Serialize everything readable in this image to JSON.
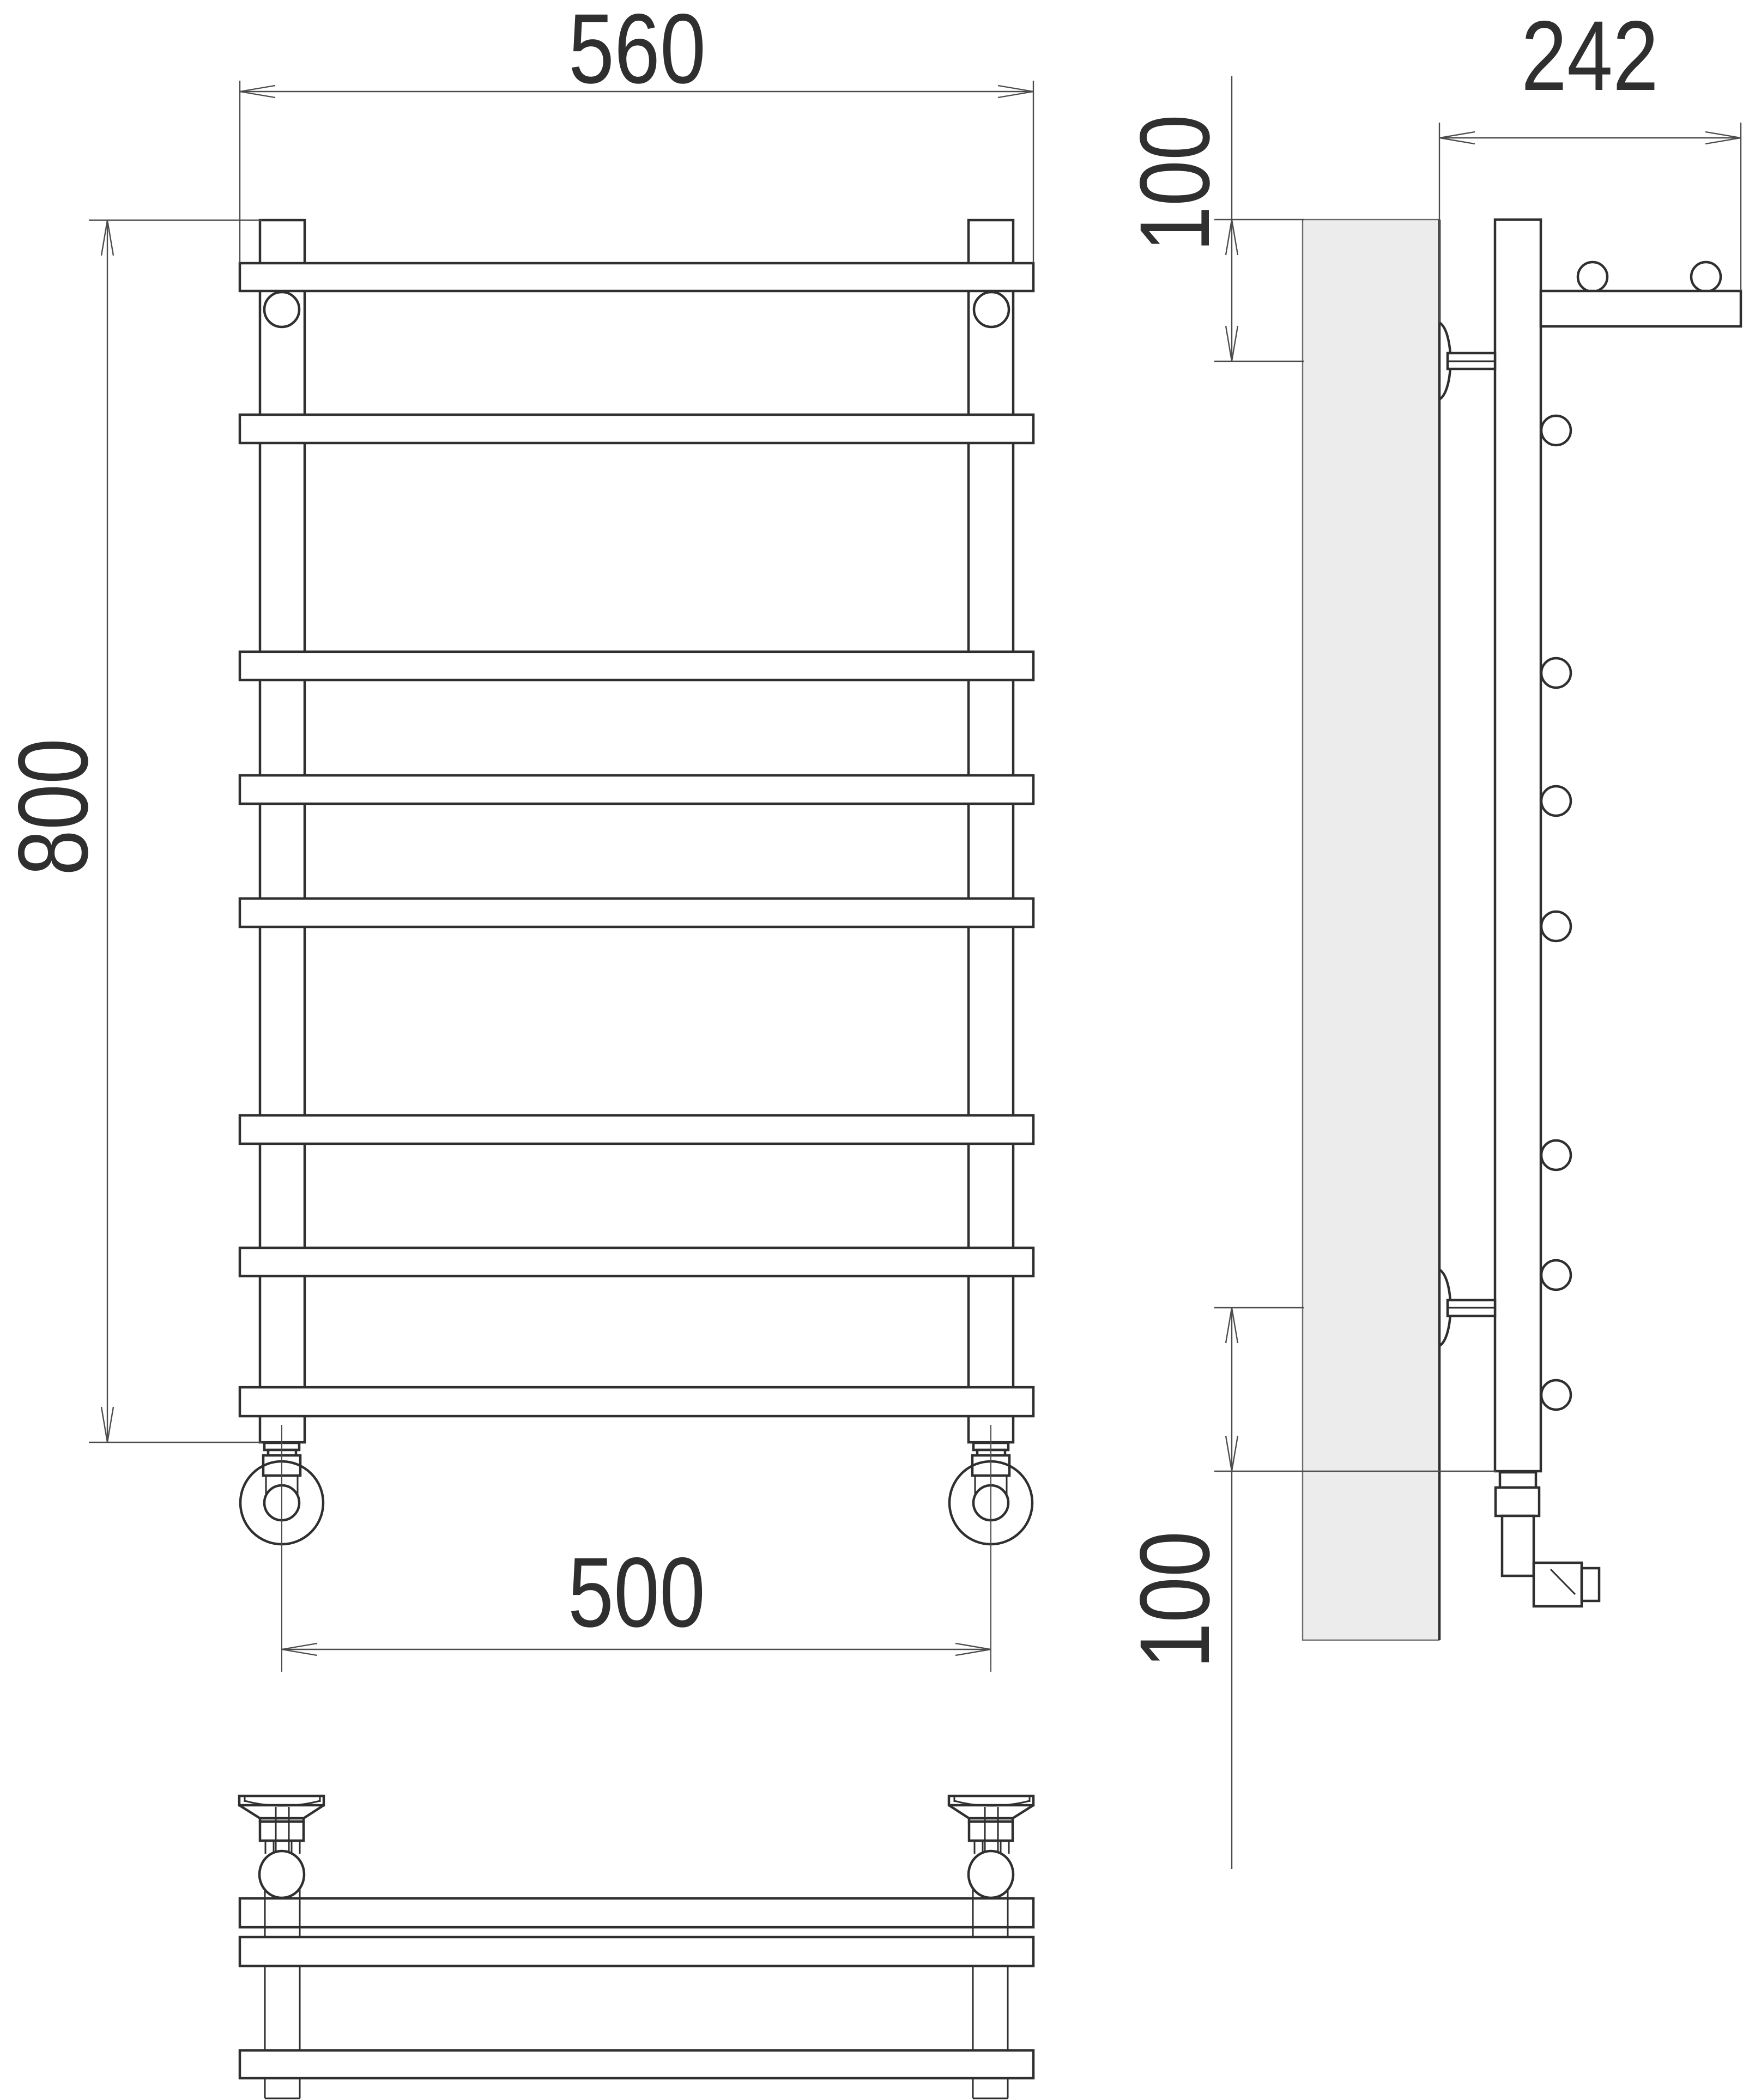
{
  "drawing": {
    "kind": "technical-dimension-drawing",
    "subject": "ladder towel rail with top shelf, three orthographic views",
    "colors": {
      "background": "#ffffff",
      "outline": "#2f2f2f",
      "dimension_lines": "#4c4c4c",
      "wall_section_fill": "#ececec"
    },
    "front_view": {
      "rung_count": 8,
      "dimensions": {
        "width_top": "560",
        "height": "800",
        "connection_spacing": "500"
      }
    },
    "side_view": {
      "rung_end_count": 7,
      "dimensions": {
        "depth": "242",
        "top_bracket_offset": "100",
        "bottom_bracket_offset": "100"
      }
    },
    "bottom_view": {
      "shelf_tube_count": 2
    }
  }
}
